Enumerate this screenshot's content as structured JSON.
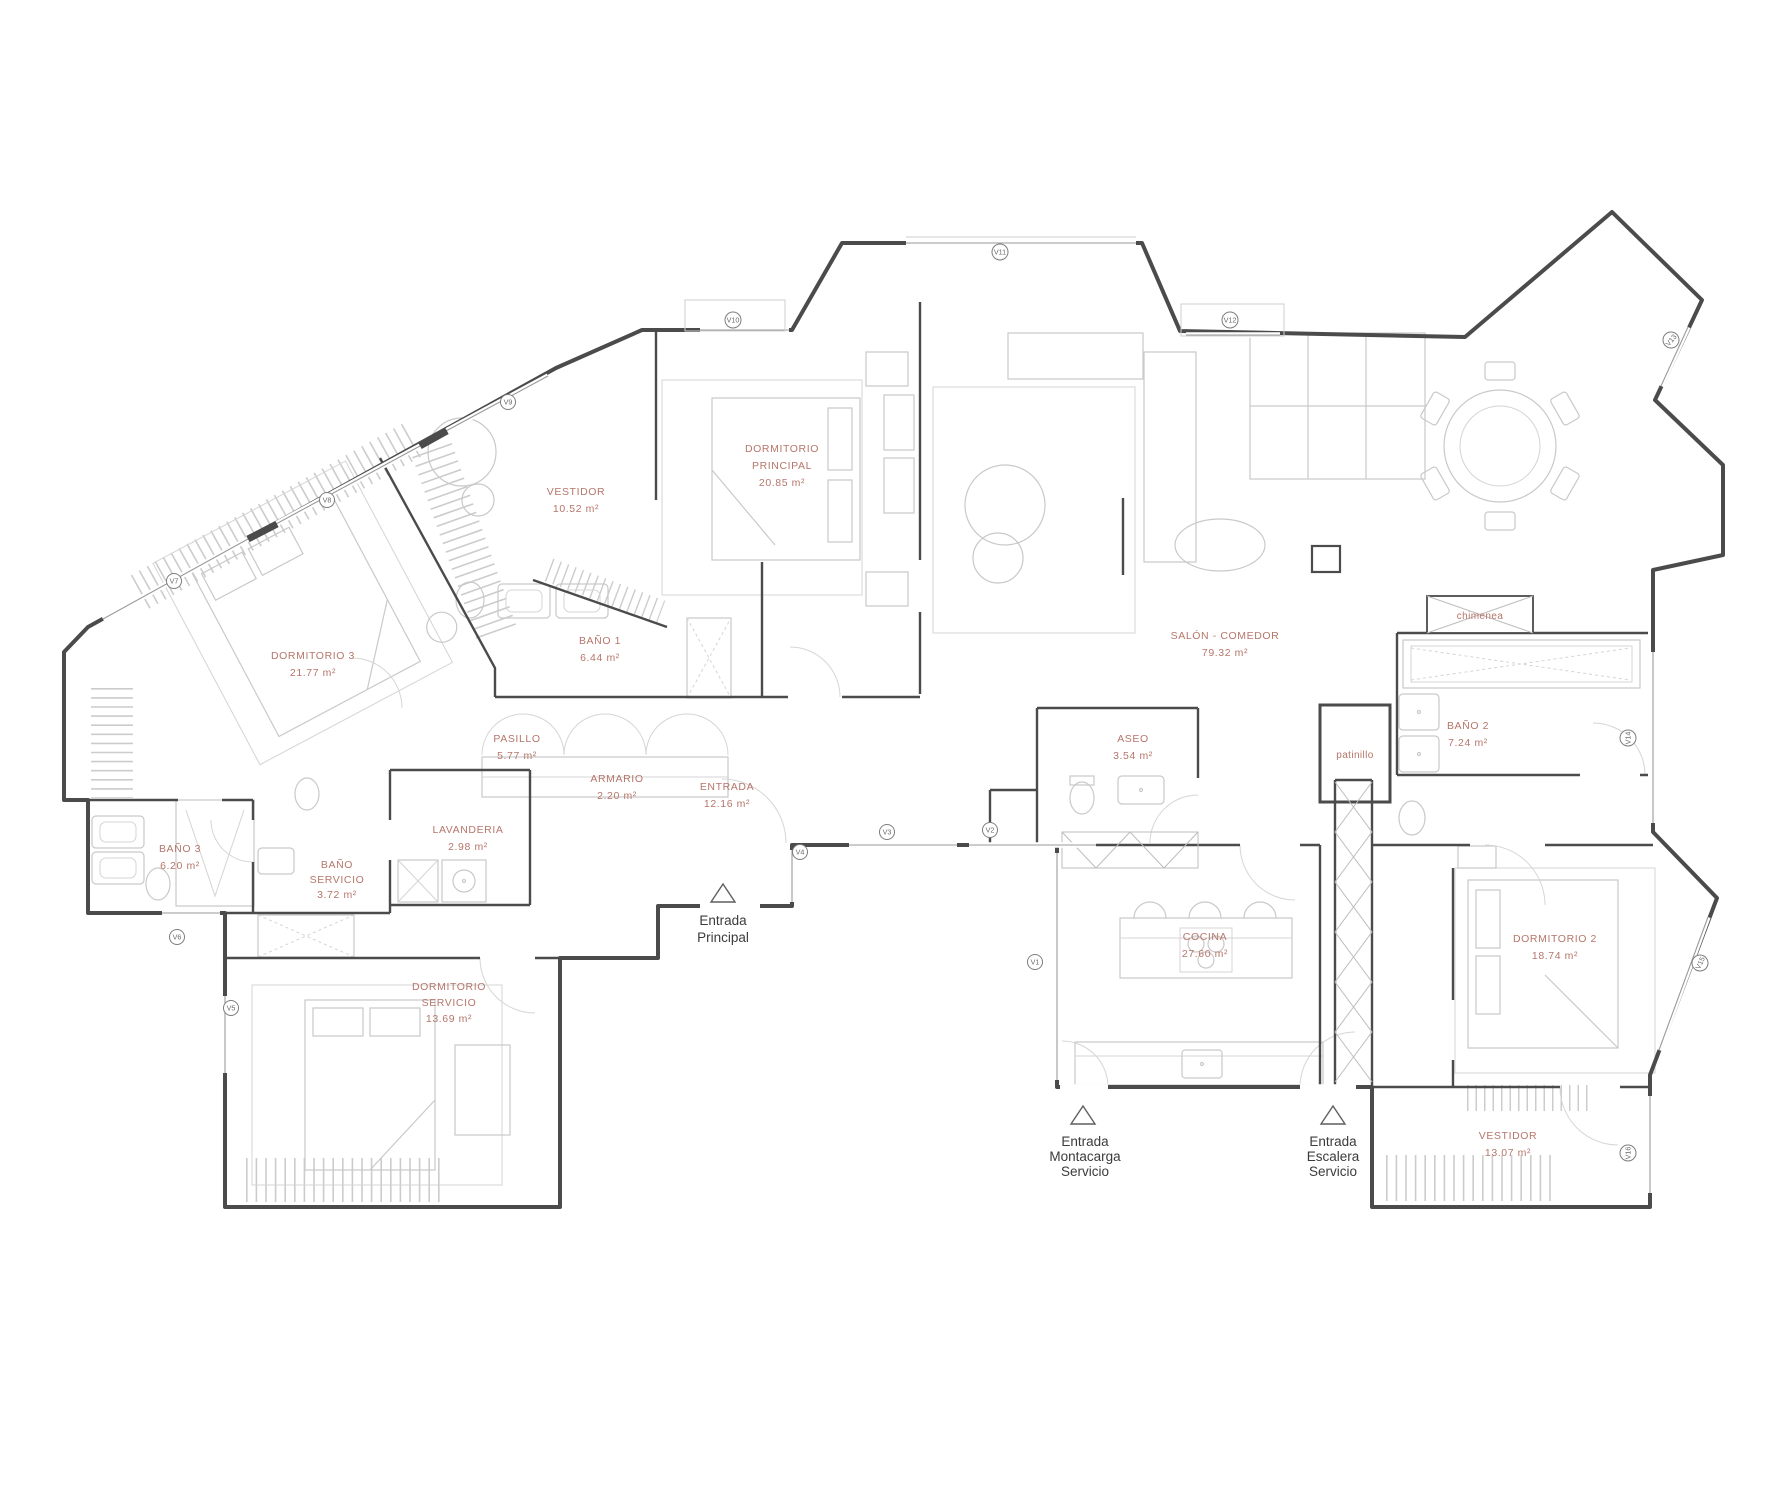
{
  "title": "Floor plan - apartment",
  "colors": {
    "wall": "#4b4b4b",
    "furniture": "#c9c9c9",
    "room_label": "#b5766a",
    "text_label": "#3b3b3b"
  },
  "rooms": {
    "dormitorio3": {
      "name": "DORMITORIO 3",
      "area": "21.77 m²"
    },
    "vestidor1": {
      "name": "VESTIDOR",
      "area": "10.52 m²"
    },
    "bano1": {
      "name": "BAÑO 1",
      "area": "6.44 m²"
    },
    "principal": {
      "name1": "DORMITORIO",
      "name2": "PRINCIPAL",
      "area": "20.85 m²"
    },
    "salon": {
      "name": "SALÓN - COMEDOR",
      "area": "79.32 m²"
    },
    "pasillo": {
      "name": "PASILLO",
      "area": "5.77 m²"
    },
    "armario": {
      "name": "ARMARIO",
      "area": "2.20 m²"
    },
    "entrada": {
      "name": "ENTRADA",
      "area": "12.16 m²"
    },
    "lavanderia": {
      "name": "LAVANDERIA",
      "area": "2.98 m²"
    },
    "bano3": {
      "name": "BAÑO 3",
      "area": "6.20 m²"
    },
    "banoServicio": {
      "name1": "BAÑO",
      "name2": "SERVICIO",
      "area": "3.72 m²"
    },
    "dormServicio": {
      "name1": "DORMITORIO",
      "name2": "SERVICIO",
      "area": "13.69 m²"
    },
    "aseo": {
      "name": "ASEO",
      "area": "3.54 m²"
    },
    "cocina": {
      "name": "COCINA",
      "area": "27.60 m²"
    },
    "bano2": {
      "name": "BAÑO 2",
      "area": "7.24 m²"
    },
    "dormitorio2": {
      "name": "DORMITORIO 2",
      "area": "18.74 m²"
    },
    "vestidor2": {
      "name": "VESTIDOR",
      "area": "13.07 m²"
    },
    "patinillo": {
      "name": "patinillo"
    },
    "chimenea": {
      "name": "chimenea"
    }
  },
  "windows": {
    "v1": "V1",
    "v2": "V2",
    "v3": "V3",
    "v4": "V4",
    "v5": "V5",
    "v6": "V6",
    "v7": "V7",
    "v8": "V8",
    "v9": "V9",
    "v10": "V10",
    "v11": "V11",
    "v12": "V12",
    "v13": "V13",
    "v14": "V14",
    "v15": "V15",
    "v16": "V16"
  },
  "entrances": {
    "principal": {
      "line1": "Entrada",
      "line2": "Principal"
    },
    "montacarga": {
      "line1": "Entrada",
      "line2": "Montacarga",
      "line3": "Servicio"
    },
    "escalera": {
      "line1": "Entrada",
      "line2": "Escalera",
      "line3": "Servicio"
    }
  }
}
